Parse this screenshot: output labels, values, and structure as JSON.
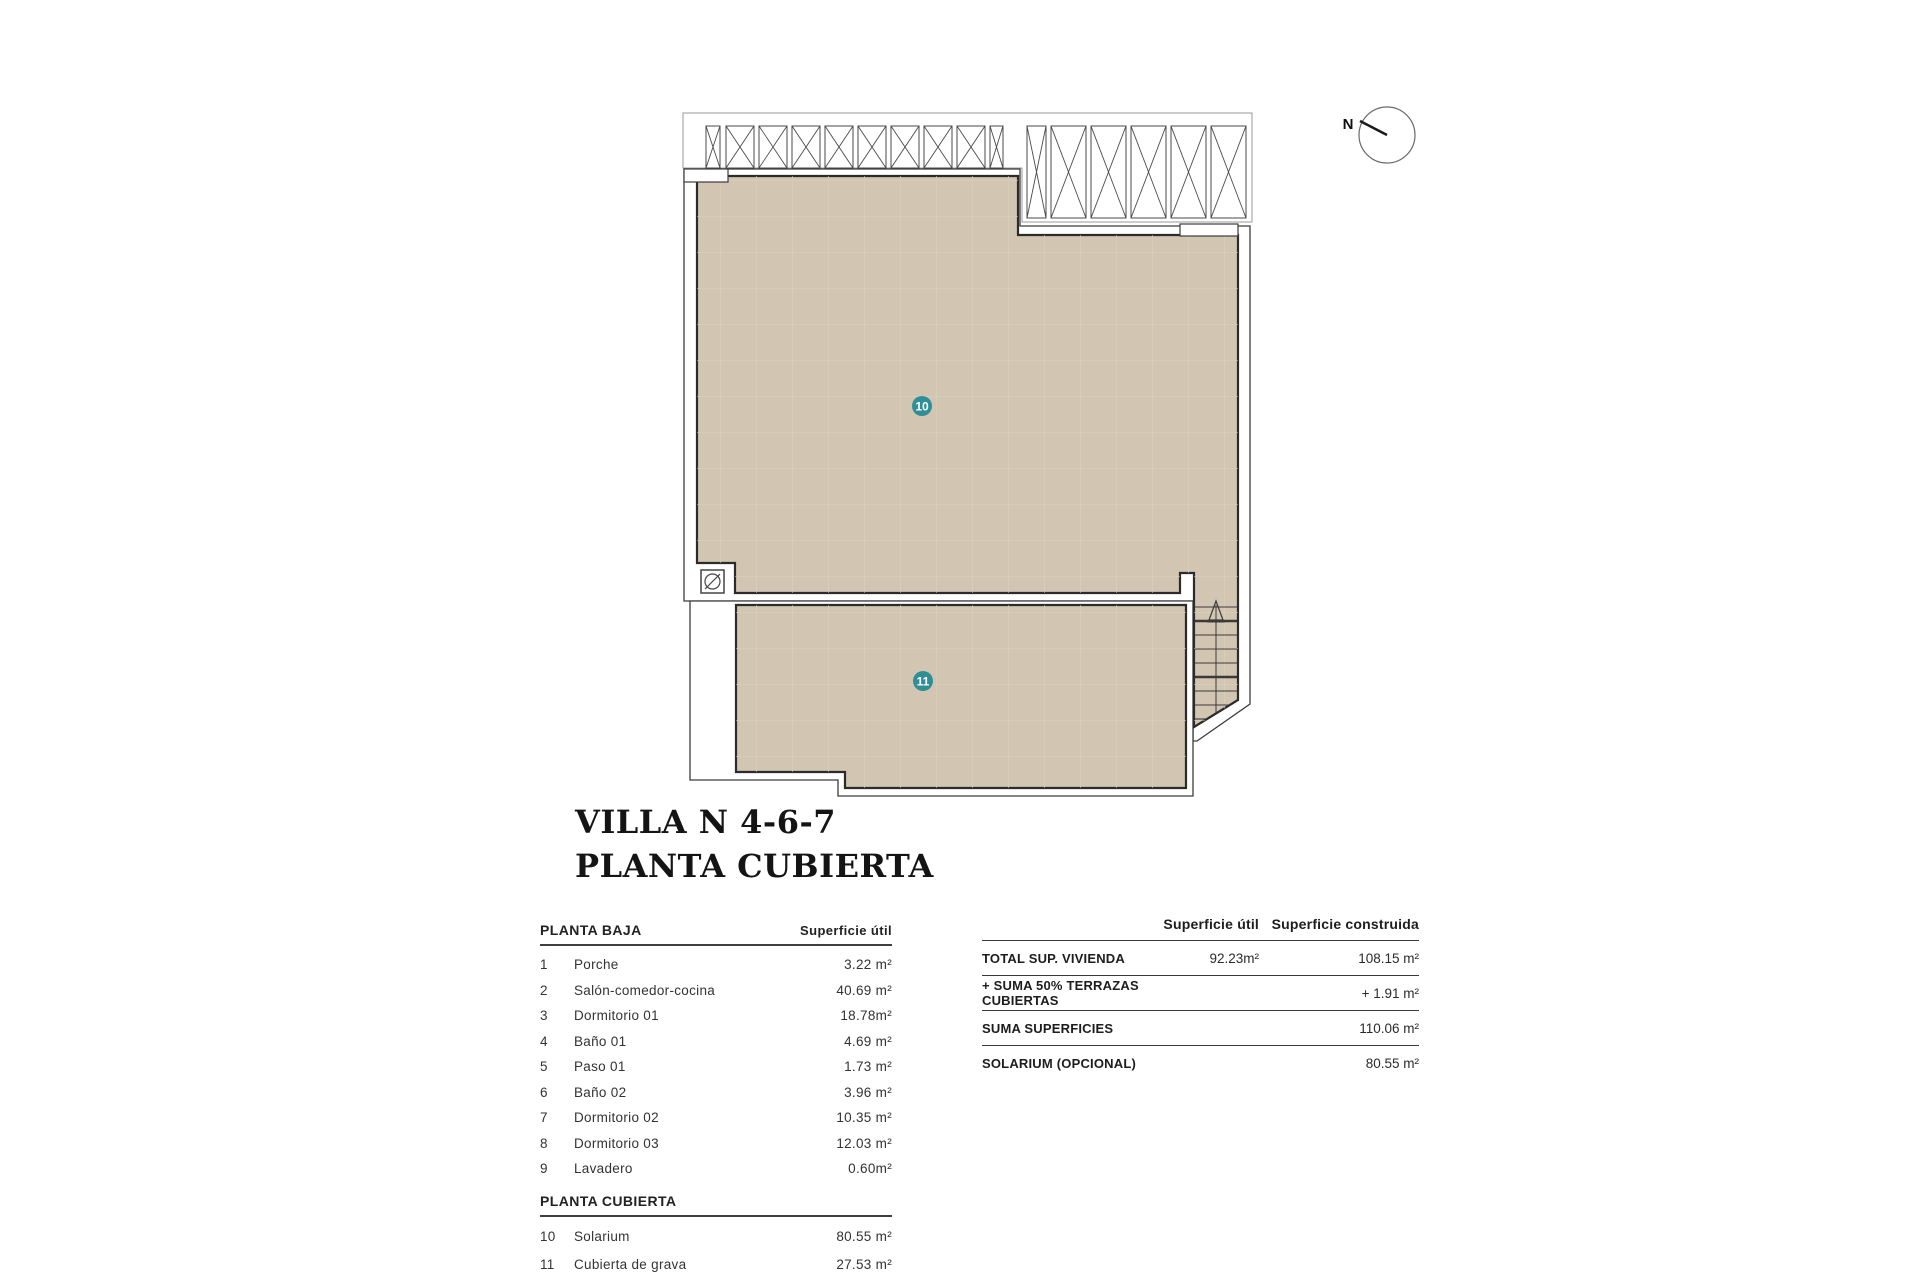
{
  "title": {
    "line1": "VILLA N 4-6-7",
    "line2": "PLANTA CUBIERTA"
  },
  "compass": {
    "label": "N"
  },
  "plan": {
    "marker_10": "10",
    "marker_11": "11"
  },
  "colors": {
    "roof_fill": "#d2c5b2",
    "roof_grid": "#ddd1bf",
    "marker_teal": "#2f8f96",
    "outline_dark": "#2b2b2b"
  },
  "left_table": {
    "section1": {
      "header": "PLANTA BAJA",
      "value_header": "Superficie útil",
      "rows": [
        {
          "num": "1",
          "name": "Porche",
          "value": "3.22 m²"
        },
        {
          "num": "2",
          "name": "Salón-comedor-cocina",
          "value": "40.69 m²"
        },
        {
          "num": "3",
          "name": "Dormitorio 01",
          "value": "18.78m²"
        },
        {
          "num": "4",
          "name": "Baño 01",
          "value": "4.69 m²"
        },
        {
          "num": "5",
          "name": "Paso 01",
          "value": "1.73 m²"
        },
        {
          "num": "6",
          "name": "Baño 02",
          "value": "3.96 m²"
        },
        {
          "num": "7",
          "name": "Dormitorio 02",
          "value": "10.35 m²"
        },
        {
          "num": "8",
          "name": "Dormitorio 03",
          "value": "12.03 m²"
        },
        {
          "num": "9",
          "name": "Lavadero",
          "value": "0.60m²"
        }
      ]
    },
    "section2": {
      "header": "PLANTA CUBIERTA",
      "rows": [
        {
          "num": "10",
          "name": "Solarium",
          "value": "80.55 m²"
        },
        {
          "num": "11",
          "name": "Cubierta de grava",
          "value": "27.53 m²"
        }
      ]
    }
  },
  "right_table": {
    "col1_header": "Superficie útil",
    "col2_header": "Superficie construida",
    "rows": [
      {
        "label": "TOTAL SUP. VIVIENDA",
        "util": "92.23m²",
        "construida": "108.15 m²"
      },
      {
        "label": "+ SUMA 50% TERRAZAS CUBIERTAS",
        "util": "",
        "construida": "+ 1.91 m²"
      },
      {
        "label": "SUMA SUPERFICIES",
        "util": "",
        "construida": "110.06 m²"
      },
      {
        "label": "SOLARIUM (OPCIONAL)",
        "util": "",
        "construida": "80.55 m²"
      }
    ]
  }
}
